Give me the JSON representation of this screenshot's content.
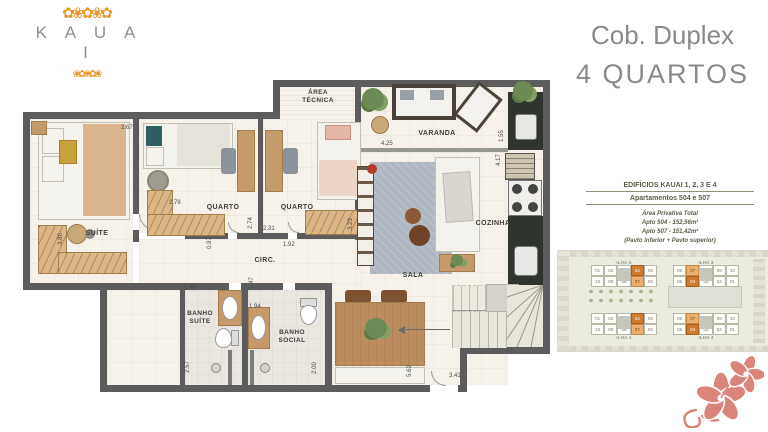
{
  "logo": {
    "brand": "K A U A I",
    "tagline": "··· ········ ···",
    "flowers_top": "✿❀✿❀✿",
    "flowers_bottom": "❀✿❀✿❀"
  },
  "title": {
    "line1": "Cob. Duplex",
    "line2": "4 QUARTOS"
  },
  "info": {
    "heading1": "EDIFÍCIOS KAUAI 1, 2, 3 E 4",
    "heading2": "Apartamentos 504 e 507",
    "area_title": "Área Privativa Total",
    "apto1": "Apto 504 - 152,56m²",
    "apto2": "Apto 507 - 151,42m²",
    "note": "(Pavto inferior + Pavto superior)"
  },
  "keyplan": {
    "blocks": [
      {
        "label": "ILHA 2",
        "rows": [
          [
            "01",
            "02",
            "03",
            "04",
            "05"
          ],
          [
            "10",
            "09",
            "08",
            "07",
            "06"
          ]
        ],
        "hl_dark": "04",
        "hl_light": "07"
      },
      {
        "label": "ILHA 3",
        "rows": [
          [
            "06",
            "07",
            "08",
            "09",
            "10"
          ],
          [
            "05",
            "04",
            "03",
            "02",
            "01"
          ]
        ],
        "hl_dark": "04",
        "hl_light": "07"
      },
      {
        "label": "ILHA 1",
        "rows": [
          [
            "01",
            "02",
            "03",
            "04",
            "05"
          ],
          [
            "10",
            "09",
            "08",
            "07",
            "06"
          ]
        ],
        "hl_dark": "04",
        "hl_light": "07"
      },
      {
        "label": "ILHA 4",
        "rows": [
          [
            "06",
            "07",
            "08",
            "09",
            "10"
          ],
          [
            "05",
            "04",
            "03",
            "02",
            "01"
          ]
        ],
        "hl_dark": "04",
        "hl_light": "07"
      }
    ]
  },
  "plan": {
    "rooms": {
      "suite": "SUÍTE",
      "quarto1": "QUARTO",
      "quarto2": "QUARTO",
      "area_tecnica_1": "ÁREA",
      "area_tecnica_2": "TÉCNICA",
      "varanda": "VARANDA",
      "cozinha": "COZINHA",
      "sala": "SALA",
      "circ": "CIRC.",
      "banho_suite_1": "BANHO",
      "banho_suite_2": "SUÍTE",
      "banho_social_1": "BANHO",
      "banho_social_2": "SOCIAL"
    },
    "dims": [
      "2.67",
      "3.80",
      "2.78",
      "2.74",
      "2.31",
      "1.92",
      "3.23",
      "0.97",
      "4.25",
      "1.55",
      "4.17",
      "1.49",
      "1.47",
      "1.94",
      "2.57",
      "2.00",
      "5.62",
      "3.41"
    ]
  },
  "colors": {
    "accent_orange": "#e8952d",
    "coral": "#d9857a",
    "wall": "#5c5c5c",
    "title_gray": "#8a8a8a",
    "highlight_dark": "#cf7d2c",
    "highlight_light": "#ecaf6d"
  }
}
